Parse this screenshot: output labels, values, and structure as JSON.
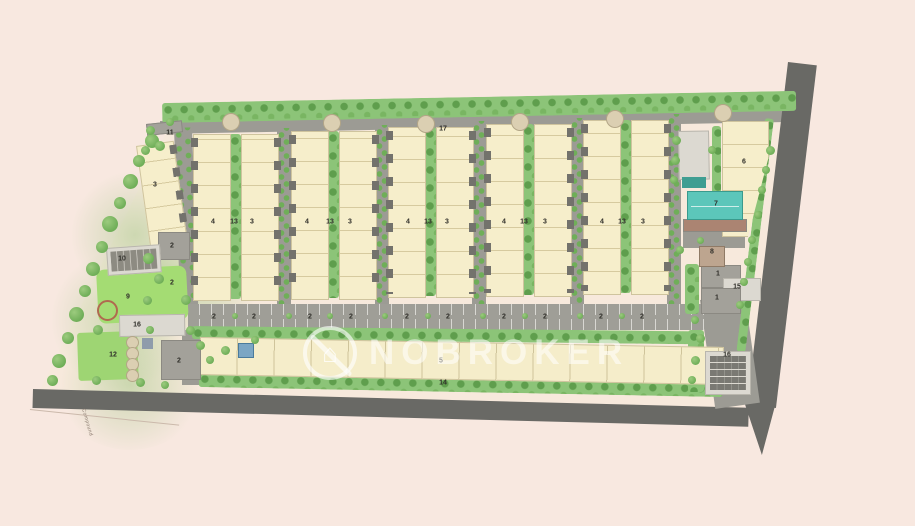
{
  "watermark": {
    "brand": "NOBROKER",
    "logo": "no-broker-house-icon"
  },
  "boundary_label": "Compound",
  "unit_markers": [
    {
      "v": "11",
      "x": 170,
      "y": 133
    },
    {
      "v": "17",
      "x": 443,
      "y": 129
    },
    {
      "v": "3",
      "x": 155,
      "y": 185
    },
    {
      "v": "2",
      "x": 172,
      "y": 246
    },
    {
      "v": "10",
      "x": 122,
      "y": 259
    },
    {
      "v": "2",
      "x": 172,
      "y": 283
    },
    {
      "v": "9",
      "x": 128,
      "y": 297
    },
    {
      "v": "16",
      "x": 137,
      "y": 325
    },
    {
      "v": "12",
      "x": 113,
      "y": 355
    },
    {
      "v": "2",
      "x": 179,
      "y": 361
    },
    {
      "v": "4",
      "x": 213,
      "y": 222
    },
    {
      "v": "13",
      "x": 234,
      "y": 222
    },
    {
      "v": "3",
      "x": 252,
      "y": 222
    },
    {
      "v": "4",
      "x": 307,
      "y": 222
    },
    {
      "v": "13",
      "x": 330,
      "y": 222
    },
    {
      "v": "3",
      "x": 350,
      "y": 222
    },
    {
      "v": "4",
      "x": 408,
      "y": 222
    },
    {
      "v": "13",
      "x": 428,
      "y": 222
    },
    {
      "v": "3",
      "x": 447,
      "y": 222
    },
    {
      "v": "4",
      "x": 504,
      "y": 222
    },
    {
      "v": "13",
      "x": 524,
      "y": 222
    },
    {
      "v": "3",
      "x": 545,
      "y": 222
    },
    {
      "v": "4",
      "x": 602,
      "y": 222
    },
    {
      "v": "13",
      "x": 622,
      "y": 222
    },
    {
      "v": "3",
      "x": 643,
      "y": 222
    },
    {
      "v": "2",
      "x": 214,
      "y": 317
    },
    {
      "v": "2",
      "x": 254,
      "y": 317
    },
    {
      "v": "2",
      "x": 310,
      "y": 317
    },
    {
      "v": "2",
      "x": 351,
      "y": 317
    },
    {
      "v": "2",
      "x": 407,
      "y": 317
    },
    {
      "v": "2",
      "x": 448,
      "y": 317
    },
    {
      "v": "2",
      "x": 504,
      "y": 317
    },
    {
      "v": "2",
      "x": 545,
      "y": 317
    },
    {
      "v": "2",
      "x": 601,
      "y": 317
    },
    {
      "v": "2",
      "x": 642,
      "y": 317
    },
    {
      "v": "5",
      "x": 441,
      "y": 361
    },
    {
      "v": "14",
      "x": 443,
      "y": 383
    },
    {
      "v": "6",
      "x": 744,
      "y": 162
    },
    {
      "v": "7",
      "x": 716,
      "y": 204
    },
    {
      "v": "8",
      "x": 712,
      "y": 252
    },
    {
      "v": "1",
      "x": 718,
      "y": 274
    },
    {
      "v": "15",
      "x": 737,
      "y": 287
    },
    {
      "v": "1",
      "x": 717,
      "y": 298
    },
    {
      "v": "16",
      "x": 727,
      "y": 355
    }
  ],
  "colors": {
    "background": "#f8e8e0",
    "road_dark": "#696965",
    "road_light": "#9c9b94",
    "building_cream": "#f6eecb",
    "green": "#8cc478",
    "lawn": "#a4dc73",
    "pool": "#5cc6ba",
    "deck": "#ab8472"
  }
}
